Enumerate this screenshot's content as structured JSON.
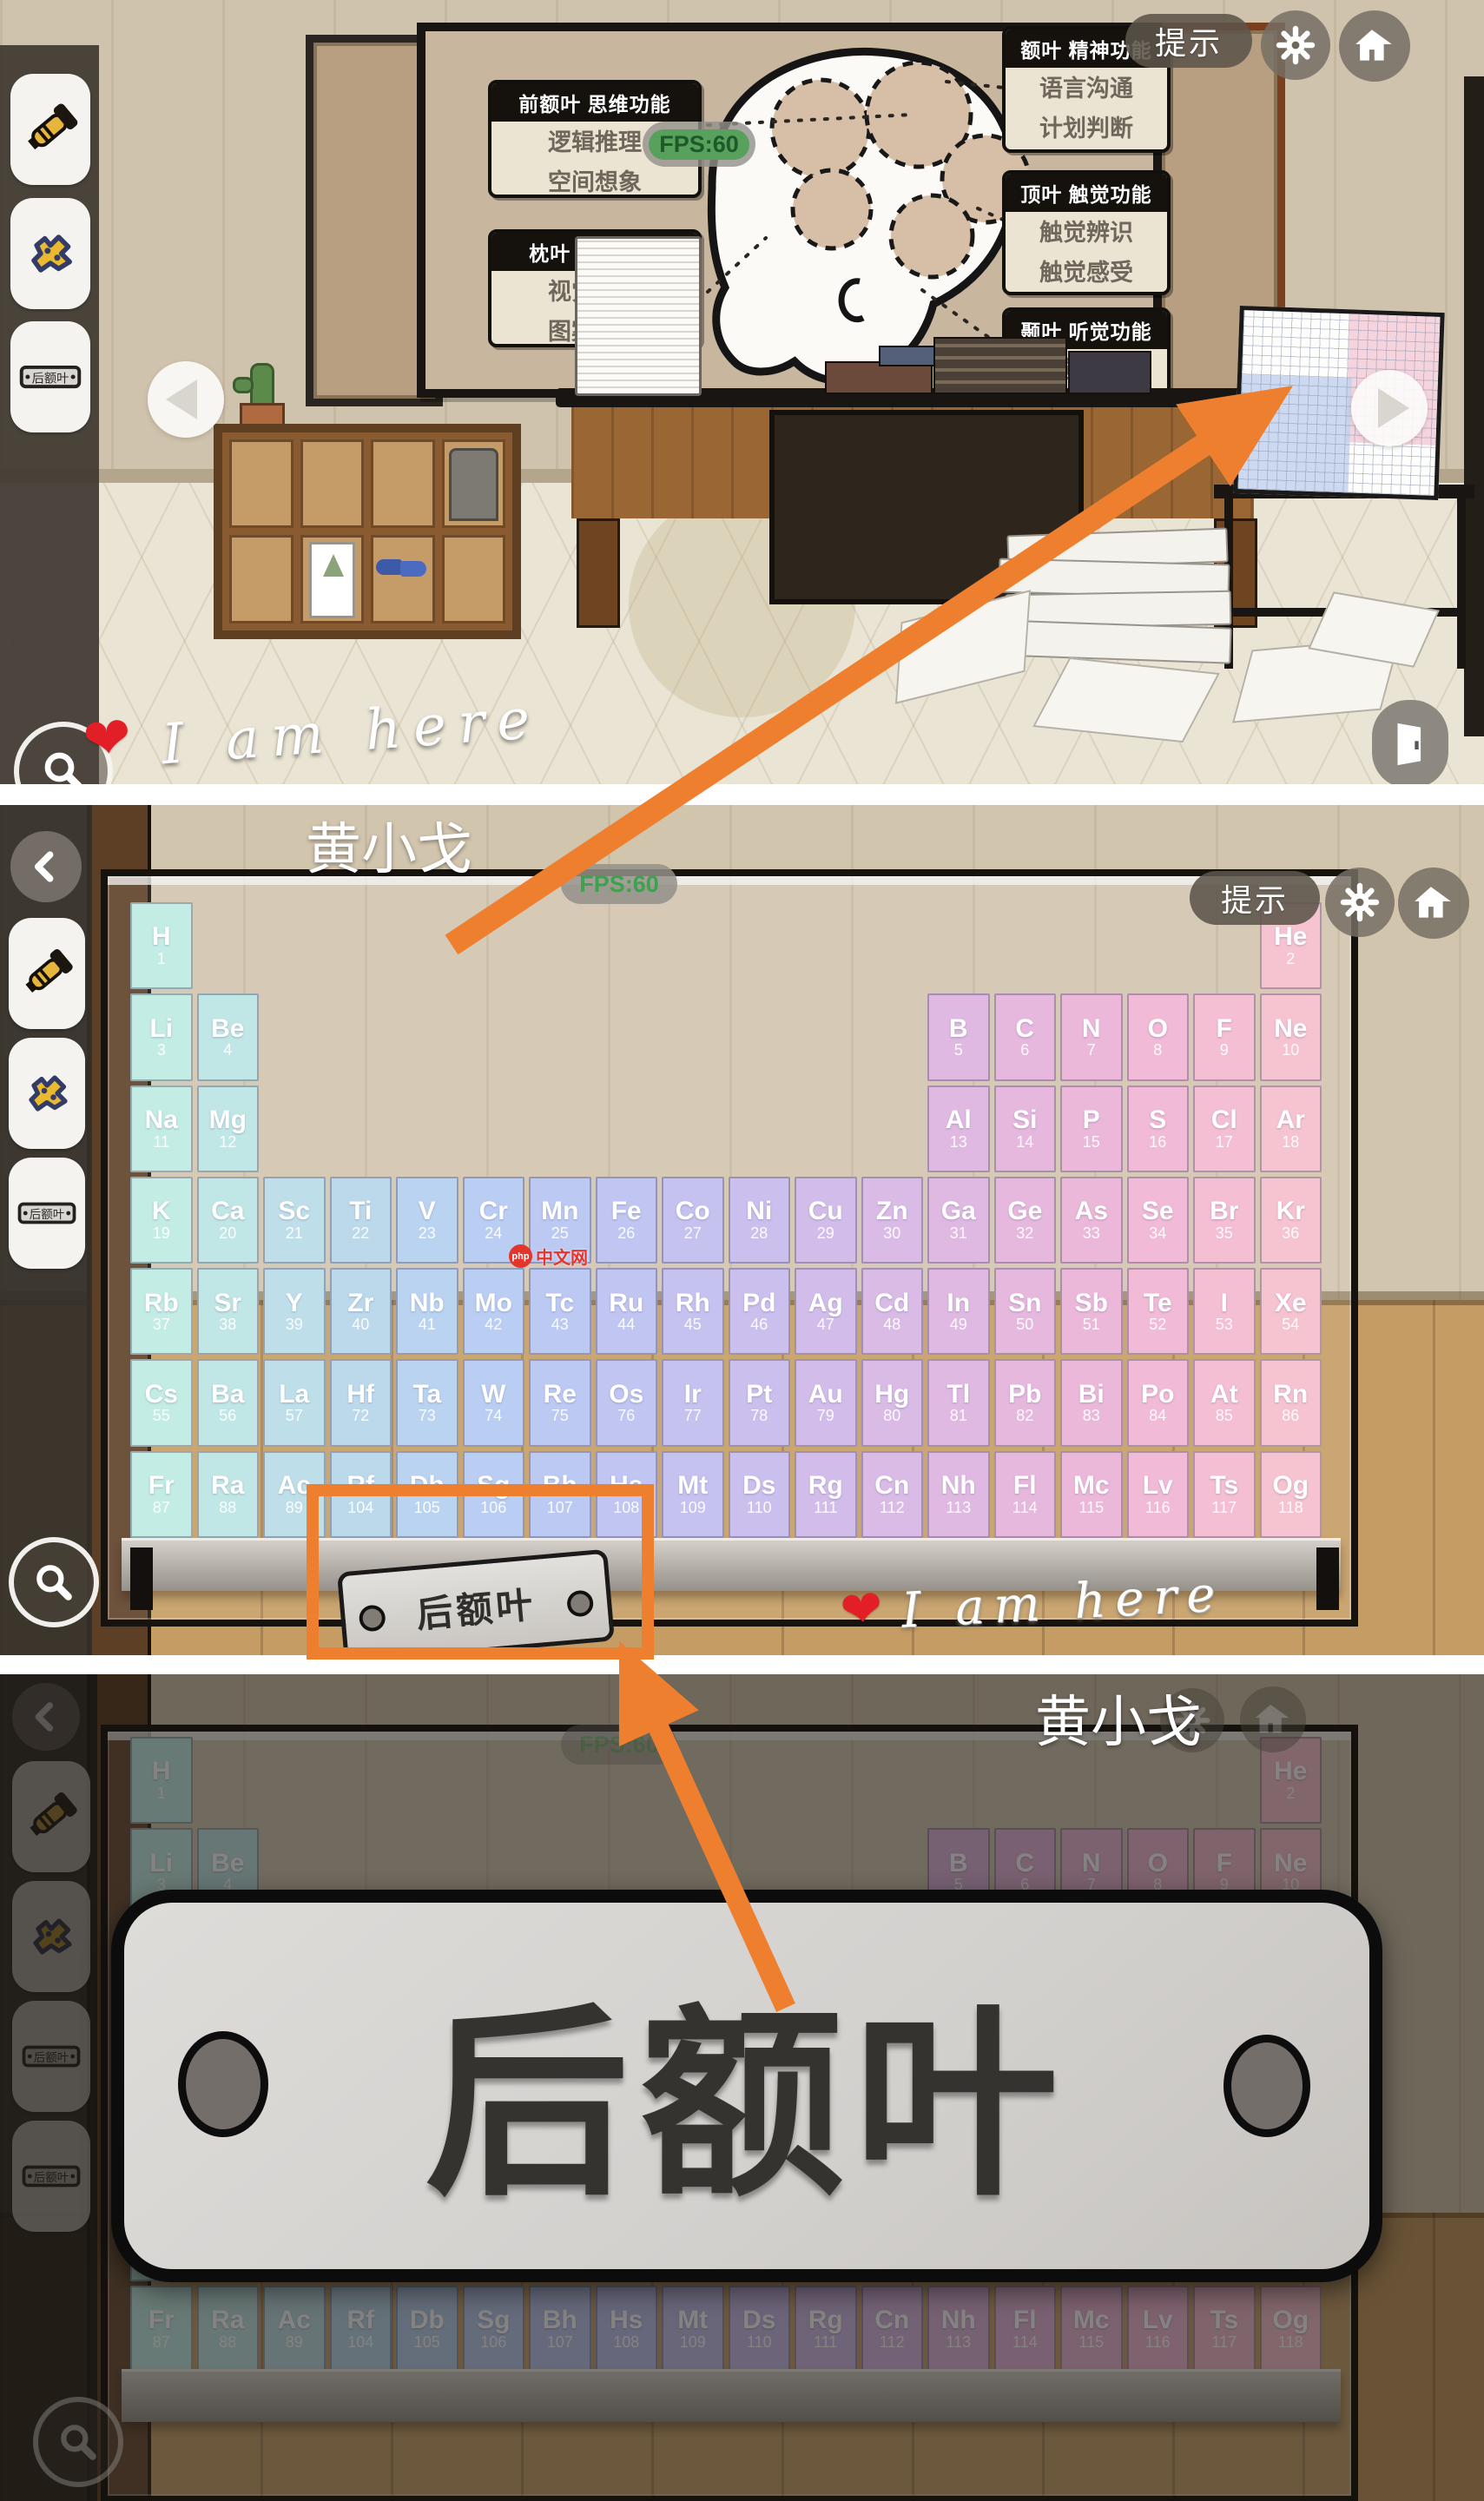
{
  "ui": {
    "hint_label": "提示",
    "fps_label": "FPS:60",
    "player_name": "黄小戈",
    "here_text": "I am here",
    "heart": "❤",
    "watermark_brand": "php",
    "watermark_text": "中文网"
  },
  "plate": {
    "text": "后额叶"
  },
  "inventory": {
    "items": [
      "flashlight",
      "puzzle-piece",
      "name-plate",
      "name-plate-new"
    ]
  },
  "brain_board": {
    "left_labels": [
      {
        "title": "前额叶 思维功能",
        "lines": [
          "逻辑推理",
          "空间想象"
        ]
      },
      {
        "title": "枕叶 视觉功能",
        "lines": [
          "视觉辨识",
          "图案理解"
        ]
      }
    ],
    "right_labels": [
      {
        "title": "额叶 精神功能",
        "lines": [
          "语言沟通",
          "计划判断"
        ]
      },
      {
        "title": "顶叶 触觉功能",
        "lines": [
          "触觉辨识",
          "触觉感受"
        ]
      },
      {
        "title": "颞叶 听觉功能",
        "lines": [
          "听觉辨识",
          "听觉感受"
        ]
      }
    ]
  },
  "periodic_table": {
    "columns": 18,
    "column_colors": [
      "#c3ece5",
      "#c0e6e6",
      "#bedfe9",
      "#bcd9ec",
      "#bad3f0",
      "#bacdf2",
      "#bcc9f3",
      "#c0c5f2",
      "#c5c2f0",
      "#cbbfee",
      "#d2bdea",
      "#d9bbe6",
      "#dfb9e2",
      "#e6b8de",
      "#ecb8da",
      "#f1bad6",
      "#f4bed3",
      "#f6c3d1"
    ],
    "rows": [
      [
        [
          "H",
          1,
          1
        ],
        [
          "He",
          2,
          18
        ]
      ],
      [
        [
          "Li",
          3,
          1
        ],
        [
          "Be",
          4,
          2
        ],
        [
          "B",
          5,
          13
        ],
        [
          "C",
          6,
          14
        ],
        [
          "N",
          7,
          15
        ],
        [
          "O",
          8,
          16
        ],
        [
          "F",
          9,
          17
        ],
        [
          "Ne",
          10,
          18
        ]
      ],
      [
        [
          "Na",
          11,
          1
        ],
        [
          "Mg",
          12,
          2
        ],
        [
          "Al",
          13,
          13
        ],
        [
          "Si",
          14,
          14
        ],
        [
          "P",
          15,
          15
        ],
        [
          "S",
          16,
          16
        ],
        [
          "Cl",
          17,
          17
        ],
        [
          "Ar",
          18,
          18
        ]
      ],
      [
        [
          "K",
          19,
          1
        ],
        [
          "Ca",
          20,
          2
        ],
        [
          "Sc",
          21,
          3
        ],
        [
          "Ti",
          22,
          4
        ],
        [
          "V",
          23,
          5
        ],
        [
          "Cr",
          24,
          6
        ],
        [
          "Mn",
          25,
          7
        ],
        [
          "Fe",
          26,
          8
        ],
        [
          "Co",
          27,
          9
        ],
        [
          "Ni",
          28,
          10
        ],
        [
          "Cu",
          29,
          11
        ],
        [
          "Zn",
          30,
          12
        ],
        [
          "Ga",
          31,
          13
        ],
        [
          "Ge",
          32,
          14
        ],
        [
          "As",
          33,
          15
        ],
        [
          "Se",
          34,
          16
        ],
        [
          "Br",
          35,
          17
        ],
        [
          "Kr",
          36,
          18
        ]
      ],
      [
        [
          "Rb",
          37,
          1
        ],
        [
          "Sr",
          38,
          2
        ],
        [
          "Y",
          39,
          3
        ],
        [
          "Zr",
          40,
          4
        ],
        [
          "Nb",
          41,
          5
        ],
        [
          "Mo",
          42,
          6
        ],
        [
          "Tc",
          43,
          7
        ],
        [
          "Ru",
          44,
          8
        ],
        [
          "Rh",
          45,
          9
        ],
        [
          "Pd",
          46,
          10
        ],
        [
          "Ag",
          47,
          11
        ],
        [
          "Cd",
          48,
          12
        ],
        [
          "In",
          49,
          13
        ],
        [
          "Sn",
          50,
          14
        ],
        [
          "Sb",
          51,
          15
        ],
        [
          "Te",
          52,
          16
        ],
        [
          "I",
          53,
          17
        ],
        [
          "Xe",
          54,
          18
        ]
      ],
      [
        [
          "Cs",
          55,
          1
        ],
        [
          "Ba",
          56,
          2
        ],
        [
          "La",
          57,
          3
        ],
        [
          "Hf",
          72,
          4
        ],
        [
          "Ta",
          73,
          5
        ],
        [
          "W",
          74,
          6
        ],
        [
          "Re",
          75,
          7
        ],
        [
          "Os",
          76,
          8
        ],
        [
          "Ir",
          77,
          9
        ],
        [
          "Pt",
          78,
          10
        ],
        [
          "Au",
          79,
          11
        ],
        [
          "Hg",
          80,
          12
        ],
        [
          "Tl",
          81,
          13
        ],
        [
          "Pb",
          82,
          14
        ],
        [
          "Bi",
          83,
          15
        ],
        [
          "Po",
          84,
          16
        ],
        [
          "At",
          85,
          17
        ],
        [
          "Rn",
          86,
          18
        ]
      ],
      [
        [
          "Fr",
          87,
          1
        ],
        [
          "Ra",
          88,
          2
        ],
        [
          "Ac",
          89,
          3
        ],
        [
          "Rf",
          104,
          4
        ],
        [
          "Db",
          105,
          5
        ],
        [
          "Sg",
          106,
          6
        ],
        [
          "Bh",
          107,
          7
        ],
        [
          "Hs",
          108,
          8
        ],
        [
          "Mt",
          109,
          9
        ],
        [
          "Ds",
          110,
          10
        ],
        [
          "Rg",
          111,
          11
        ],
        [
          "Cn",
          112,
          12
        ],
        [
          "Nh",
          113,
          13
        ],
        [
          "Fl",
          114,
          14
        ],
        [
          "Mc",
          115,
          15
        ],
        [
          "Lv",
          116,
          16
        ],
        [
          "Ts",
          117,
          17
        ],
        [
          "Og",
          118,
          18
        ]
      ]
    ]
  },
  "annotation_colors": {
    "orange": "#ee7f2e",
    "heart_red": "#e21f26"
  }
}
